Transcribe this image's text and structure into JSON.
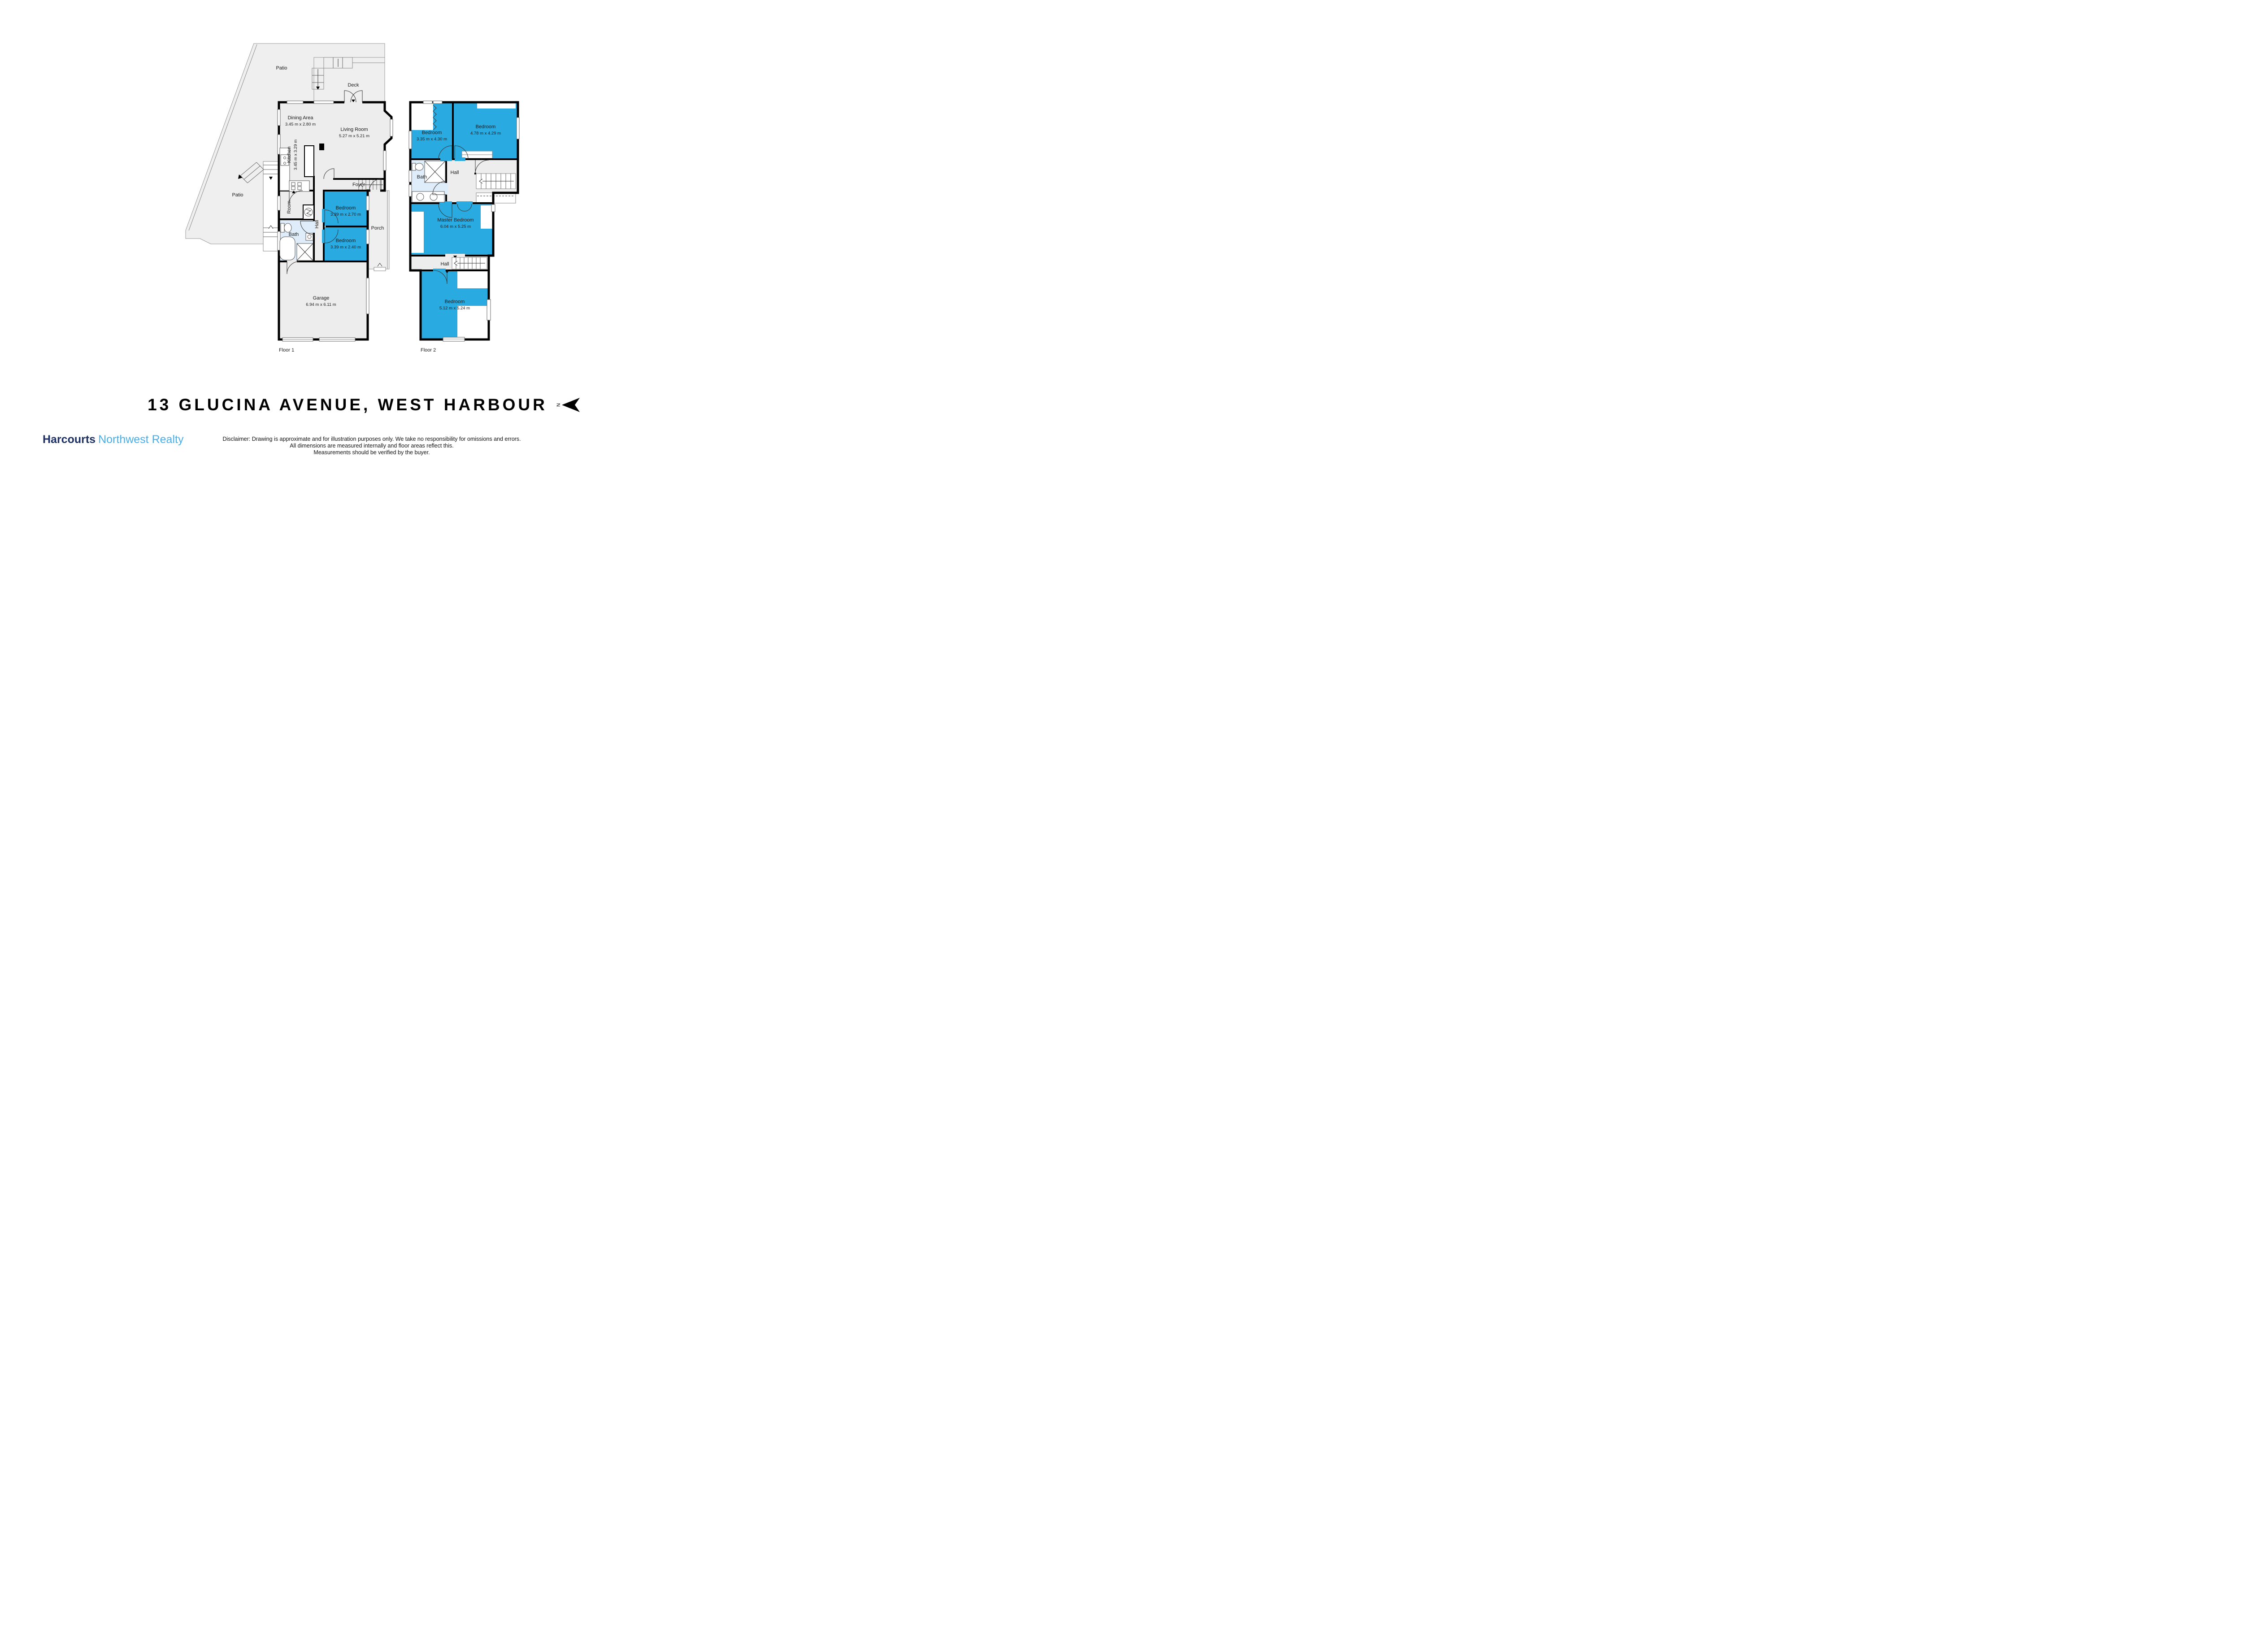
{
  "page": {
    "title": "13 GLUCINA AVENUE, WEST HARBOUR"
  },
  "north": {
    "label": "N"
  },
  "branding": {
    "brand": "Harcourts",
    "suffix": "Northwest Realty",
    "brand_color": "#1C2F63",
    "suffix_color": "#4AAEE6"
  },
  "disclaimer": {
    "line1": "Disclaimer: Drawing is approximate and for illustration purposes only. We take no responsibility for omissions and errors.",
    "line2": "All dimensions are measured internally and floor areas reflect this.",
    "line3": "Measurements should be verified by the buyer."
  },
  "colors": {
    "bedroom_fill": "#29ABE2",
    "bath_fill": "#DEEDF9",
    "floor_fill": "#EDEDED",
    "patio_fill": "#EFEFEF",
    "wall": "#000000"
  },
  "floor1": {
    "label": "Floor 1",
    "rooms": {
      "patio_top": {
        "name": "Patio"
      },
      "deck": {
        "name": "Deck"
      },
      "patio_left": {
        "name": "Patio"
      },
      "dining": {
        "name": "Dining Area",
        "dims": "3.45 m x 2.80 m"
      },
      "living": {
        "name": "Living Room",
        "dims": "5.27 m x 5.21 m"
      },
      "kitchen": {
        "name": "Kitchen",
        "dims": "3.45 m x 3.29 m"
      },
      "foyer": {
        "name": "Foyer"
      },
      "room": {
        "name": "Room"
      },
      "hall": {
        "name": "Hall"
      },
      "bath": {
        "name": "Bath"
      },
      "bedroom_top": {
        "name": "Bedroom",
        "dims": "3.39 m x 2.70 m"
      },
      "bedroom_bottom": {
        "name": "Bedroom",
        "dims": "3.39 m x 2.40 m"
      },
      "porch": {
        "name": "Porch"
      },
      "garage": {
        "name": "Garage",
        "dims": "6.94 m x 6.11 m"
      }
    }
  },
  "floor2": {
    "label": "Floor 2",
    "rooms": {
      "bedroom_left": {
        "name": "Bedroom",
        "dims": "3.35 m x 4.30 m"
      },
      "bedroom_right": {
        "name": "Bedroom",
        "dims": "4.78 m x 4.29 m"
      },
      "bath": {
        "name": "Bath"
      },
      "hall_upper": {
        "name": "Hall"
      },
      "master": {
        "name": "Master Bedroom",
        "dims": "6.04 m x 5.25 m"
      },
      "hall_lower": {
        "name": "Hall"
      },
      "bedroom_lower": {
        "name": "Bedroom",
        "dims": "5.12 m x 5.24 m"
      }
    }
  }
}
